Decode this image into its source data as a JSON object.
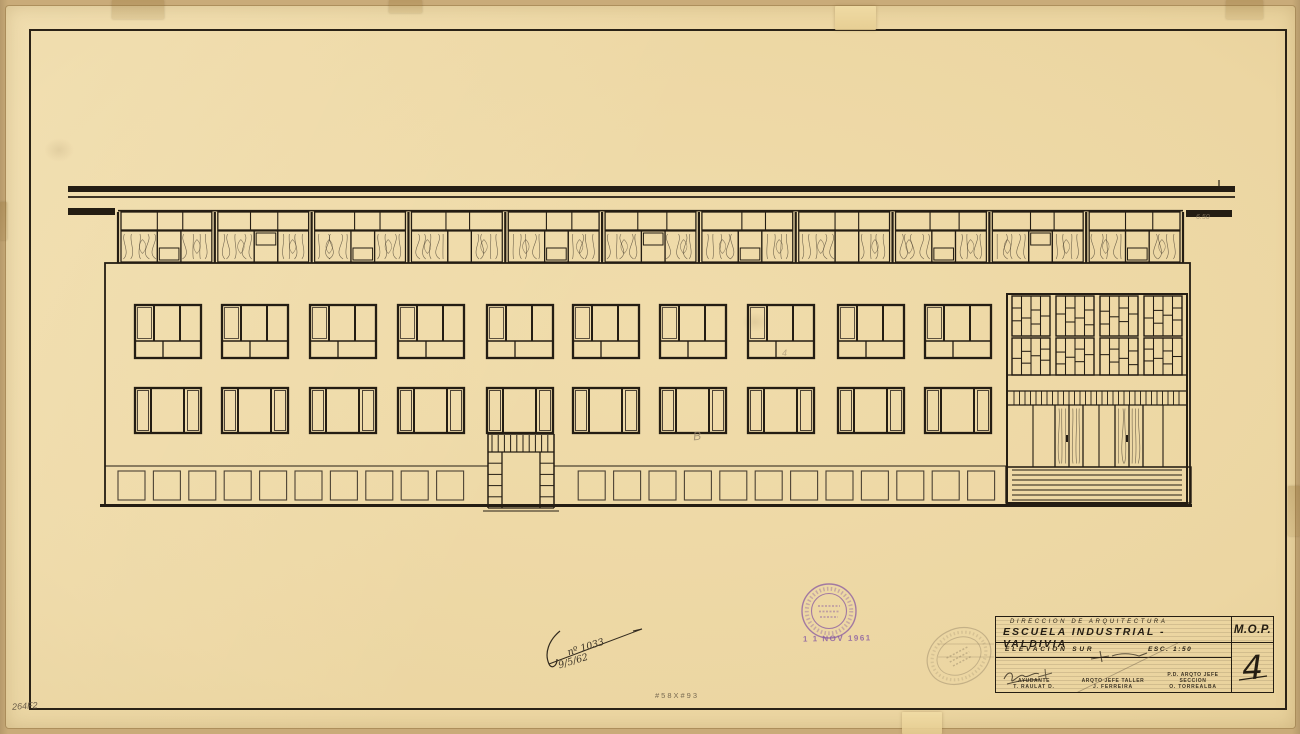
{
  "title_block": {
    "dept_line": "DIRECCION  DE  ARQUITECTURA",
    "project_line": "ESCUELA INDUSTRIAL - VALDIVIA",
    "view_label": "ELEVACION  SUR",
    "scale_label": "ESC. 1:50",
    "org_label": "M.O.P.",
    "sheet_number": "4",
    "signatories": [
      {
        "role": "AYUDANTE",
        "name": "T. RAULAT D."
      },
      {
        "role": "ARQTO JEFE TALLER",
        "name": "J. FERREIRA"
      },
      {
        "role": "P.D. ARQTO JEFE SECCION",
        "name": "O. TORREALBA"
      }
    ]
  },
  "annotations": {
    "roof_pencil_note": "6.50",
    "facade_letter": "B",
    "facade_mark": "4",
    "ink_note_line1": "nº 1033",
    "ink_note_line2": "9/5/62",
    "date_stamp": "1 1 NOV 1961",
    "sheet_size_note": "#58X#93",
    "corner_code": "264F2"
  },
  "drawing": {
    "ink": "#241d13",
    "thin": "#3a3226",
    "light": "#4c4234",
    "roof": {
      "x1": 68,
      "x2": 1235,
      "fascia_y": 186,
      "fascia_h": 6,
      "line_y": 197,
      "soffit_left": [
        68,
        208,
        47,
        7
      ],
      "soffit_right": [
        1186,
        210,
        46,
        7
      ],
      "tick_x": 1219
    },
    "clerestory": {
      "x1": 118,
      "x2": 1183,
      "top": 210,
      "strip_top": 212,
      "strip_bottom": 230,
      "bottom": 263,
      "wood1_end": 0.4,
      "mid_end": 0.66,
      "modules": [
        {
          "s1": 0.4,
          "s2": 0.68,
          "inset": "low"
        },
        {
          "s1": 0.36,
          "s2": 0.66,
          "inset": "high"
        },
        {
          "s1": 0.44,
          "s2": 0.72,
          "inset": "low"
        },
        {
          "s1": 0.38,
          "s2": 0.64,
          "inset": "none"
        },
        {
          "s1": 0.42,
          "s2": 0.7,
          "inset": "low"
        },
        {
          "s1": 0.36,
          "s2": 0.68,
          "inset": "high"
        },
        {
          "s1": 0.44,
          "s2": 0.7,
          "inset": "low"
        },
        {
          "s1": 0.4,
          "s2": 0.66,
          "inset": "none"
        },
        {
          "s1": 0.38,
          "s2": 0.7,
          "inset": "low"
        },
        {
          "s1": 0.42,
          "s2": 0.68,
          "inset": "high"
        },
        {
          "s1": 0.4,
          "s2": 0.7,
          "inset": "low"
        }
      ]
    },
    "facade": {
      "x1": 105,
      "x2": 1190,
      "top": 263,
      "bottom": 505,
      "plinth_y": 466
    },
    "windows": {
      "xs": [
        135,
        222,
        310,
        398,
        487,
        573,
        660,
        748,
        838,
        925
      ],
      "w": 66,
      "upper_y": 305,
      "upper_h": 53,
      "lower_y": 388,
      "lower_h": 45
    },
    "plinth": {
      "y": 471,
      "h": 29,
      "w": 27,
      "pitch": 35.4,
      "start_x": 118,
      "count": 25,
      "gap": [
        478,
        562
      ]
    },
    "door": {
      "x1": 488,
      "x2": 554,
      "top": 434,
      "slat_bottom": 452,
      "bottom": 508,
      "jamb_w": 14,
      "block_h": 11.2,
      "threshold_y": 511
    },
    "entrance": {
      "x1": 1007,
      "x2": 1187,
      "top": 294,
      "bottom": 503,
      "mosaic_rows": [
        {
          "y": 296,
          "h": 40
        },
        {
          "y": 338,
          "h": 37
        }
      ],
      "group_xs": [
        1012,
        1056,
        1100,
        1144
      ],
      "group_w": 38,
      "mosaic": [
        [
          [
            0.3,
            0.62
          ],
          [
            0.55
          ],
          [
            0.35,
            0.7
          ],
          [
            0.5
          ]
        ],
        [
          [
            0.45
          ],
          [
            0.3,
            0.65
          ],
          [
            0.55
          ],
          [
            0.35,
            0.72
          ]
        ],
        [
          [
            0.38,
            0.7
          ],
          [
            0.52
          ],
          [
            0.3,
            0.64
          ],
          [
            0.45
          ]
        ],
        [
          [
            0.55
          ],
          [
            0.36,
            0.68
          ],
          [
            0.48
          ],
          [
            0.3,
            0.6
          ]
        ]
      ],
      "band_y": 375,
      "slat_top": 391,
      "slat_bottom": 405,
      "door_bottom": 467,
      "panel_lines": [
        1033,
        1099,
        1163
      ],
      "leaf_edges": [
        1055,
        1069,
        1083,
        1115,
        1129,
        1143
      ],
      "wood_leaves": [
        [
          1055,
          1069
        ],
        [
          1069,
          1083
        ],
        [
          1115,
          1129
        ],
        [
          1129,
          1143
        ]
      ],
      "handle_xs": [
        1066,
        1126
      ],
      "steps": {
        "x1": 1012,
        "x2": 1182,
        "ys": [
          470,
          475,
          480,
          485,
          490,
          495,
          500
        ],
        "outer": [
          1006,
          467,
          185,
          36
        ]
      }
    },
    "ground": {
      "x1": 100,
      "x2": 1192,
      "y": 504,
      "h": 3
    },
    "stamp_round": {
      "cx": 829,
      "cy": 611,
      "r_outer": 27,
      "r_inner": 17.5,
      "color": "#8d5fa2"
    },
    "stamp_faint": {
      "cx": 959,
      "cy": 656,
      "rx": 33,
      "ry": 27,
      "rot": -28,
      "color": "#8a7a5e"
    },
    "ink_stroke": {
      "d1": "M560,631 C549,640 544,653 549,664 C551,669 557,667 557,659",
      "d2": "M549,664 L642,629 L633,631"
    }
  }
}
